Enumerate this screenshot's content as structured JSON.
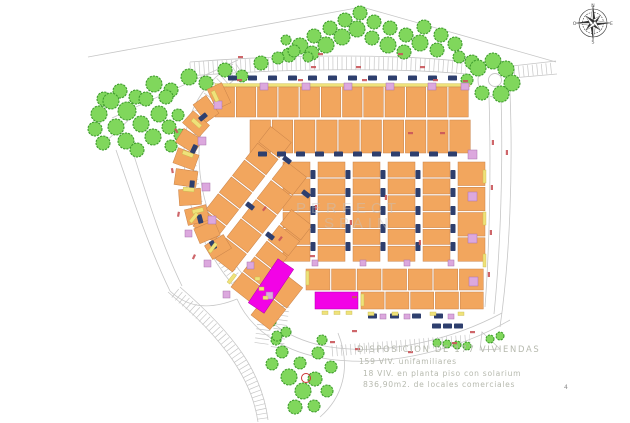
{
  "legend": {
    "line1": "DISPOSICION DE 177 VIVIENDAS",
    "line2": "159 VIV. unifamiliares",
    "line3": "18 VIV. en planta piso con solarium",
    "line4": "836,90m2. de locales comerciales"
  },
  "watermark": {
    "line1": "PERFECT",
    "line2": "SPAIN"
  },
  "footer_mark": "4",
  "compass": {
    "n": "N",
    "e": "E",
    "s": "S",
    "w": "O"
  },
  "colors": {
    "building_orange": "#F2A65E",
    "building_outline": "#C9834A",
    "accent_yellow": "#EFE27A",
    "accent_yellow_outline": "#C6B94E",
    "accent_pink": "#DCA8DE",
    "accent_pink_outline": "#A873AC",
    "car_navy": "#2E3F6E",
    "tree_green": "#80D75C",
    "tree_outline": "#3F9C2E",
    "commercial_magenta": "#F203E6",
    "commercial_outline": "#B000B0",
    "road_gray": "#C6C6C6",
    "red_label": "#C9555A",
    "red_circle": "#CC3333",
    "legend_text": "#B6B9AE",
    "watermark_gray": "#C4C4C4",
    "compass_dark": "#333333"
  },
  "plan": {
    "roads": [
      "M88,57 L362,7 L556,62",
      "M112,118 L238,60",
      "M99,148 L136,113",
      "M116,150 C135,205 150,250 170,291",
      "M130,143 C148,200 162,245 182,286",
      "M190,62 C290,54 400,54 468,62",
      "M188,76 C290,68 400,68 466,74",
      "M512,66 L556,61",
      "M512,78 L557,74",
      "M233,64 C198,86 183,120 184,158 C185,203 202,252 240,293",
      "M245,72 C213,92 198,123 199,158 C200,200 216,246 251,284",
      "M489,97 C491,160 490,240 485,307",
      "M501,96 C503,160 501,245 494,314",
      "M510,92 C513,170 510,258 500,327",
      "M247,291 C262,322 292,341 330,347 C390,356 455,338 502,313",
      "M237,299 C252,333 288,353 328,359 C392,368 462,348 510,320",
      "M170,291 C185,305 205,312 237,299",
      "M168,292 C225,340 252,380 258,422",
      "M180,287 C235,335 262,372 268,420",
      "M482,332 L500,349 L480,350 Z",
      "M338,333 C352,368 342,398 320,417"
    ],
    "combs": [
      {
        "d": "M190,69 C290,61.5 400,61.5 466,68",
        "w": 13
      },
      {
        "d": "M514,72 L554,68",
        "w": 11
      },
      {
        "d": "M239,68 C205,89 190,122 191,158 C192,201 208,249 245,289",
        "w": 11
      },
      {
        "d": "M267,302 L261,347",
        "w": 14
      },
      {
        "d": "M283,306 L277,350",
        "w": 13
      },
      {
        "d": "M332,351 L470,340",
        "w": 11
      },
      {
        "d": "M175,293 C230,338 258,377 263,421",
        "w": 11
      }
    ],
    "roundabout": {
      "cx": 495,
      "cy": 80,
      "r_outer": 17,
      "r_inner": 6.5
    },
    "blocks": [
      {
        "x": 215,
        "y": 87,
        "w": 255,
        "h": 30,
        "u": 12,
        "yellow_top": true
      },
      {
        "x": 250,
        "y": 120,
        "w": 222,
        "h": 33,
        "u": 10
      },
      {
        "x": 283,
        "y": 162,
        "w": 27,
        "h": 101,
        "u": 6,
        "v": 1
      },
      {
        "x": 318,
        "y": 162,
        "w": 27,
        "h": 101,
        "u": 6,
        "v": 1
      },
      {
        "x": 353,
        "y": 162,
        "w": 27,
        "h": 101,
        "u": 6,
        "v": 1
      },
      {
        "x": 388,
        "y": 162,
        "w": 27,
        "h": 101,
        "u": 6,
        "v": 1
      },
      {
        "x": 423,
        "y": 162,
        "w": 27,
        "h": 101,
        "u": 6,
        "v": 1
      },
      {
        "x": 458,
        "y": 162,
        "w": 27,
        "h": 101,
        "u": 4,
        "v": 1
      },
      {
        "x": 306,
        "y": 269,
        "w": 179,
        "h": 21,
        "u": 7
      },
      {
        "x": 361,
        "y": 292,
        "w": 124,
        "h": 17,
        "u": 5
      },
      {
        "x": 193,
        "y": 226,
        "w": 128,
        "h": 26,
        "u": 6,
        "r": -52
      },
      {
        "x": 212,
        "y": 256,
        "w": 122,
        "h": 26,
        "u": 5,
        "r": -52
      },
      {
        "x": 231,
        "y": 287,
        "w": 100,
        "h": 26,
        "u": 5,
        "r": -52
      },
      {
        "x": 251,
        "y": 315,
        "w": 55,
        "h": 24,
        "u": 2,
        "r": -52
      }
    ],
    "arc_houses": [
      [
        219,
        96,
        -25
      ],
      [
        206,
        109,
        -36
      ],
      [
        196,
        124,
        -48
      ],
      [
        189,
        141,
        -58
      ],
      [
        186,
        159,
        -70
      ],
      [
        186,
        178,
        -82
      ],
      [
        190,
        197,
        -94
      ],
      [
        197,
        215,
        -104
      ],
      [
        207,
        232,
        -113
      ],
      [
        218,
        247,
        -121
      ]
    ],
    "commercial": {
      "diagonal": {
        "cx": 271,
        "cy": 286,
        "rot": -56,
        "w": 53,
        "h": 19
      },
      "horizontal": {
        "x": 315,
        "y": 292,
        "w": 43,
        "h": 17
      }
    },
    "car_rows": [
      {
        "x": 228,
        "y": 78,
        "c": 12,
        "s": 20
      },
      {
        "x": 258,
        "y": 154,
        "c": 11,
        "s": 19
      },
      {
        "x": 313,
        "y": 170,
        "c": 5,
        "s": 18,
        "v": 1
      },
      {
        "x": 348,
        "y": 170,
        "c": 5,
        "s": 18,
        "v": 1
      },
      {
        "x": 383,
        "y": 170,
        "c": 5,
        "s": 18,
        "v": 1
      },
      {
        "x": 418,
        "y": 170,
        "c": 5,
        "s": 18,
        "v": 1
      },
      {
        "x": 453,
        "y": 170,
        "c": 5,
        "s": 18,
        "v": 1
      },
      {
        "x": 368,
        "y": 316,
        "c": 4,
        "s": 22
      },
      {
        "x": 432,
        "y": 326,
        "c": 3,
        "s": 11
      }
    ],
    "car_singles": [
      [
        203,
        117,
        -40
      ],
      [
        194,
        149,
        -65
      ],
      [
        192,
        185,
        -85
      ],
      [
        200,
        219,
        -105
      ],
      [
        213,
        245,
        -118
      ],
      [
        250,
        206,
        38
      ],
      [
        270,
        236,
        38
      ],
      [
        287,
        160,
        38
      ],
      [
        306,
        194,
        38
      ]
    ],
    "pink": [
      [
        260,
        83,
        8,
        7
      ],
      [
        302,
        83,
        8,
        7
      ],
      [
        344,
        83,
        8,
        7
      ],
      [
        386,
        83,
        8,
        7
      ],
      [
        428,
        83,
        8,
        7
      ],
      [
        461,
        83,
        8,
        7
      ],
      [
        468,
        150,
        9,
        9
      ],
      [
        468,
        192,
        9,
        9
      ],
      [
        468,
        234,
        9,
        9
      ],
      [
        469,
        277,
        9,
        9
      ],
      [
        312,
        260,
        6,
        6
      ],
      [
        360,
        260,
        6,
        6
      ],
      [
        404,
        260,
        6,
        6
      ],
      [
        448,
        260,
        6,
        6
      ],
      [
        380,
        314,
        6,
        5
      ],
      [
        404,
        314,
        6,
        5
      ],
      [
        448,
        314,
        6,
        5
      ],
      [
        214,
        101,
        8,
        8
      ],
      [
        198,
        137,
        8,
        8
      ],
      [
        202,
        183,
        8,
        8
      ],
      [
        208,
        216,
        8,
        8
      ],
      [
        185,
        230,
        7,
        7
      ],
      [
        204,
        260,
        7,
        7
      ],
      [
        223,
        291,
        7,
        7
      ],
      [
        247,
        262,
        7,
        7
      ],
      [
        266,
        292,
        7,
        7
      ]
    ],
    "yellow": [
      [
        483,
        170,
        3,
        13,
        0
      ],
      [
        483,
        212,
        3,
        13,
        0
      ],
      [
        483,
        254,
        3,
        13,
        0
      ],
      [
        211,
        92,
        4,
        11,
        -25
      ],
      [
        191,
        121,
        4,
        11,
        -48
      ],
      [
        182,
        154,
        4,
        11,
        -70
      ],
      [
        183,
        191,
        4,
        11,
        -85
      ],
      [
        193,
        214,
        4,
        11,
        -104
      ],
      [
        189,
        221,
        11,
        3.5,
        -52
      ],
      [
        208,
        251,
        11,
        3.5,
        -52
      ],
      [
        227,
        282,
        11,
        3.5,
        -52
      ],
      [
        255,
        277,
        5,
        3.5,
        0
      ],
      [
        259,
        287,
        5,
        3.5,
        0
      ],
      [
        263,
        296,
        5,
        3.5,
        0
      ],
      [
        322,
        311,
        6,
        3.5,
        0
      ],
      [
        334,
        311,
        6,
        3.5,
        0
      ],
      [
        346,
        311,
        6,
        3.5,
        0
      ],
      [
        368,
        312,
        6,
        3.5,
        0
      ],
      [
        392,
        312,
        6,
        3.5,
        0
      ],
      [
        430,
        312,
        6,
        3.5,
        0
      ],
      [
        458,
        312,
        6,
        3.5,
        0
      ],
      [
        306,
        271,
        3,
        14,
        0
      ],
      [
        361,
        294,
        3,
        12,
        0
      ]
    ],
    "red_marks": [
      [
        237,
        79,
        0
      ],
      [
        298,
        79,
        0
      ],
      [
        362,
        79,
        0
      ],
      [
        433,
        79,
        0
      ],
      [
        463,
        80,
        0
      ],
      [
        311,
        66,
        0
      ],
      [
        356,
        66,
        0
      ],
      [
        420,
        66,
        0
      ],
      [
        238,
        56,
        0
      ],
      [
        318,
        53,
        0
      ],
      [
        398,
        53,
        0
      ],
      [
        494,
        140,
        90
      ],
      [
        493,
        185,
        90
      ],
      [
        492,
        230,
        90
      ],
      [
        490,
        272,
        90
      ],
      [
        508,
        150,
        90
      ],
      [
        317,
        205,
        90
      ],
      [
        352,
        220,
        90
      ],
      [
        387,
        195,
        90
      ],
      [
        421,
        240,
        90
      ],
      [
        352,
        296,
        0
      ],
      [
        310,
        255,
        0
      ],
      [
        408,
        132,
        0
      ],
      [
        440,
        132,
        0
      ],
      [
        330,
        341,
        0
      ],
      [
        355,
        348,
        0
      ],
      [
        408,
        351,
        0
      ],
      [
        452,
        342,
        0
      ],
      [
        470,
        331,
        0
      ],
      [
        352,
        330,
        0
      ],
      [
        176,
        128,
        60
      ],
      [
        173,
        168,
        80
      ],
      [
        180,
        212,
        100
      ],
      [
        196,
        255,
        115
      ],
      [
        262,
        210,
        -52
      ],
      [
        278,
        240,
        -52
      ]
    ],
    "trees": {
      "top_cluster": [
        [
          289,
          55,
          7
        ],
        [
          300,
          46,
          8
        ],
        [
          312,
          53,
          7
        ],
        [
          314,
          36,
          7
        ],
        [
          326,
          45,
          8
        ],
        [
          330,
          28,
          7
        ],
        [
          342,
          37,
          8
        ],
        [
          345,
          20,
          7
        ],
        [
          357,
          29,
          8
        ],
        [
          360,
          13,
          7
        ],
        [
          372,
          38,
          7
        ],
        [
          374,
          22,
          7
        ],
        [
          388,
          45,
          8
        ],
        [
          390,
          28,
          7
        ],
        [
          404,
          52,
          7
        ],
        [
          406,
          35,
          7
        ],
        [
          420,
          43,
          8
        ],
        [
          424,
          27,
          7
        ],
        [
          437,
          50,
          7
        ],
        [
          441,
          35,
          7
        ],
        [
          455,
          44,
          7
        ],
        [
          459,
          57,
          6
        ],
        [
          472,
          62,
          7
        ],
        [
          286,
          40,
          5
        ]
      ],
      "top_line": [
        [
          104,
          99,
          7
        ],
        [
          120,
          91,
          7
        ],
        [
          136,
          97,
          7
        ],
        [
          154,
          84,
          8
        ],
        [
          171,
          90,
          7
        ],
        [
          189,
          77,
          8
        ],
        [
          206,
          83,
          7
        ],
        [
          225,
          70,
          7
        ],
        [
          242,
          76,
          6
        ],
        [
          261,
          63,
          7
        ],
        [
          278,
          58,
          6
        ],
        [
          294,
          51,
          6
        ],
        [
          308,
          57,
          5
        ]
      ],
      "left_cluster": [
        [
          99,
          114,
          8
        ],
        [
          111,
          101,
          8
        ],
        [
          116,
          127,
          8
        ],
        [
          127,
          111,
          9
        ],
        [
          126,
          141,
          8
        ],
        [
          141,
          124,
          8
        ],
        [
          146,
          99,
          7
        ],
        [
          153,
          137,
          8
        ],
        [
          159,
          114,
          8
        ],
        [
          169,
          127,
          7
        ],
        [
          166,
          97,
          7
        ],
        [
          103,
          143,
          7
        ],
        [
          137,
          150,
          7
        ],
        [
          171,
          146,
          6
        ],
        [
          95,
          129,
          7
        ],
        [
          180,
          135,
          6
        ],
        [
          178,
          115,
          6
        ]
      ],
      "roundabout": [
        [
          478,
          68,
          8
        ],
        [
          493,
          61,
          8
        ],
        [
          506,
          69,
          8
        ],
        [
          512,
          83,
          8
        ],
        [
          501,
          94,
          8
        ],
        [
          482,
          93,
          7
        ],
        [
          467,
          80,
          6
        ]
      ],
      "bottom_cluster": [
        [
          282,
          352,
          6
        ],
        [
          276,
          340,
          5
        ],
        [
          272,
          364,
          6
        ],
        [
          289,
          377,
          8
        ],
        [
          300,
          363,
          6
        ],
        [
          303,
          391,
          8
        ],
        [
          315,
          379,
          7
        ],
        [
          318,
          353,
          6
        ],
        [
          327,
          391,
          6
        ],
        [
          331,
          367,
          6
        ],
        [
          295,
          407,
          7
        ],
        [
          314,
          406,
          6
        ],
        [
          286,
          332,
          5
        ],
        [
          322,
          340,
          5
        ]
      ],
      "street": [
        [
          258,
          300,
          4
        ],
        [
          263,
          311,
          4
        ],
        [
          272,
          322,
          4
        ],
        [
          277,
          336,
          5
        ],
        [
          437,
          343,
          4
        ],
        [
          447,
          344,
          4
        ],
        [
          457,
          345,
          4
        ],
        [
          467,
          346,
          4
        ],
        [
          490,
          339,
          4
        ],
        [
          500,
          336,
          4
        ]
      ]
    },
    "red_circle": {
      "cx": 306,
      "cy": 378,
      "r": 4.5
    }
  }
}
